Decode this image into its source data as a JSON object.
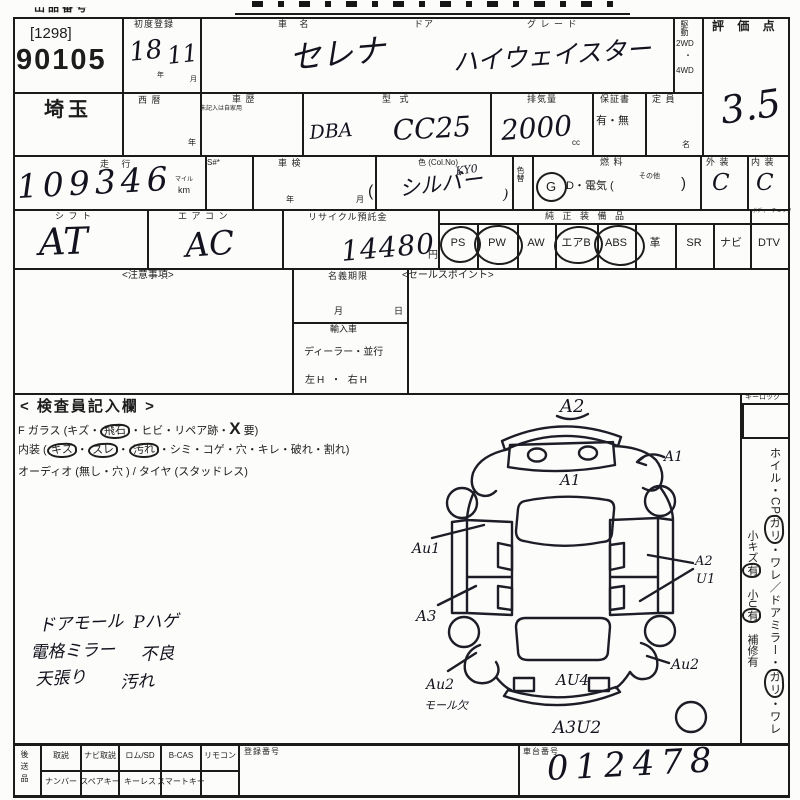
{
  "lot": {
    "header": "出品番号",
    "tag": "[1298]",
    "number": "90105",
    "prefecture": "埼玉"
  },
  "reg": {
    "label": "初度登録",
    "year": "18",
    "year_u": "年",
    "month": "11",
    "month_u": "月",
    "west": "西 暦",
    "west_u": "年"
  },
  "name": {
    "label": "車  名",
    "value": "セレナ",
    "door": "ドア",
    "grade_label": "グ レ ー ド",
    "grade": "ハイウェイスター"
  },
  "drive": {
    "label": "駆動",
    "o1": "2WD",
    "dot": "・",
    "o2": "4WD"
  },
  "score": {
    "label": "評 価 点",
    "value": "3.5"
  },
  "history": {
    "label": "車 歴",
    "note": "未記入は自家用"
  },
  "model": {
    "label": "型  式",
    "prefix": "DBA",
    "value": "CC25"
  },
  "disp": {
    "label": "排気量",
    "value": "2000",
    "unit": "cc"
  },
  "warranty": {
    "label": "保証書",
    "options": "有・無"
  },
  "capacity": {
    "label": "定 員",
    "unit": "名"
  },
  "mileage": {
    "label": "走  行",
    "value": "109346",
    "mile": "マイル",
    "km": "km",
    "s": "S#*"
  },
  "shaken": {
    "label": "車 検",
    "year": "年",
    "month": "月",
    "paren": "("
  },
  "color": {
    "label": "色 (Col.No)",
    "code": "KY0",
    "value": "シルバー",
    "close": ")",
    "change": "色替"
  },
  "fuel": {
    "label": "燃  料",
    "g": "G",
    "mid": "D・電気 (",
    "other": "その他",
    "close": ")"
  },
  "ext": {
    "label": "外 装",
    "value": "C"
  },
  "intr": {
    "label": "内 装",
    "value": "C"
  },
  "shift": {
    "label": "シ フ ト",
    "value": "AT"
  },
  "aircon": {
    "label": "エ ア コ ン",
    "value": "AC"
  },
  "recycle": {
    "label": "リサイクル預託金",
    "value": "14480",
    "unit": "円"
  },
  "equip": {
    "label": "純 正 装 備 品",
    "corner": "ボディーチェック",
    "items": [
      "PS",
      "PW",
      "AW",
      "エアB",
      "ABS",
      "革",
      "SR",
      "ナビ",
      "DTV"
    ]
  },
  "mid": {
    "notes": "<注意事項>",
    "name_limit": "名義期限",
    "month": "月",
    "day": "日",
    "import_label": "輸入車",
    "dealer": "ディーラー・並行",
    "handle": "左H ・ 右H",
    "sales": "<セールスポイント>"
  },
  "inspector": {
    "header": "< 検査員記入欄 >",
    "glass_1": "F ガラス (キズ・",
    "glass_c": "飛石",
    "glass_2": "・ヒビ・リペア跡・",
    "glass_x": "X",
    "glass_3": " 要)",
    "int_1": "内装 (",
    "int_c1": "キズ",
    "int_d1": "・",
    "int_c2": "スレ",
    "int_d2": "・",
    "int_c3": "汚れ",
    "int_2": "・シミ・コゲ・穴・キレ・破れ・割れ)",
    "audio": "オーディオ (無し・穴 ) / タイヤ (スタッドレス)",
    "notes": [
      {
        "a": "ドアモール",
        "b": "Pハゲ"
      },
      {
        "a": "電格ミラー",
        "b": "不良"
      },
      {
        "a": "天張り",
        "b": "汚れ"
      }
    ]
  },
  "sidebar": {
    "keylock": "キーロック",
    "col1": [
      "ホイル・CP",
      "ガリ",
      "・ワレ／",
      "ドアミラー・",
      "ガリ",
      "・ワレ"
    ],
    "col2": [
      "小キズ",
      "有",
      "　小U",
      "有",
      "　補修有"
    ]
  },
  "diagram": {
    "a2_top": "A2",
    "a1_center": "A1",
    "a1_right": "A1",
    "au1": "Au1",
    "a2_right": "A2",
    "u1_right": "U1",
    "a3": "A3",
    "au2_bl": "Au2",
    "moru": "モール欠",
    "au4": "AU4",
    "au2_br": "Au2",
    "a3u2": "A3U2"
  },
  "footer": {
    "send": "後送品",
    "row1": [
      "取説",
      "ナビ取説",
      "ロム/SD",
      "B-CAS",
      "リモコン"
    ],
    "row2": [
      "ナンバー",
      "スペアキー",
      "キーレス",
      "スマートキー"
    ],
    "reg_label": "登録番号",
    "chassis_label": "車台番号",
    "chassis": "012478"
  }
}
